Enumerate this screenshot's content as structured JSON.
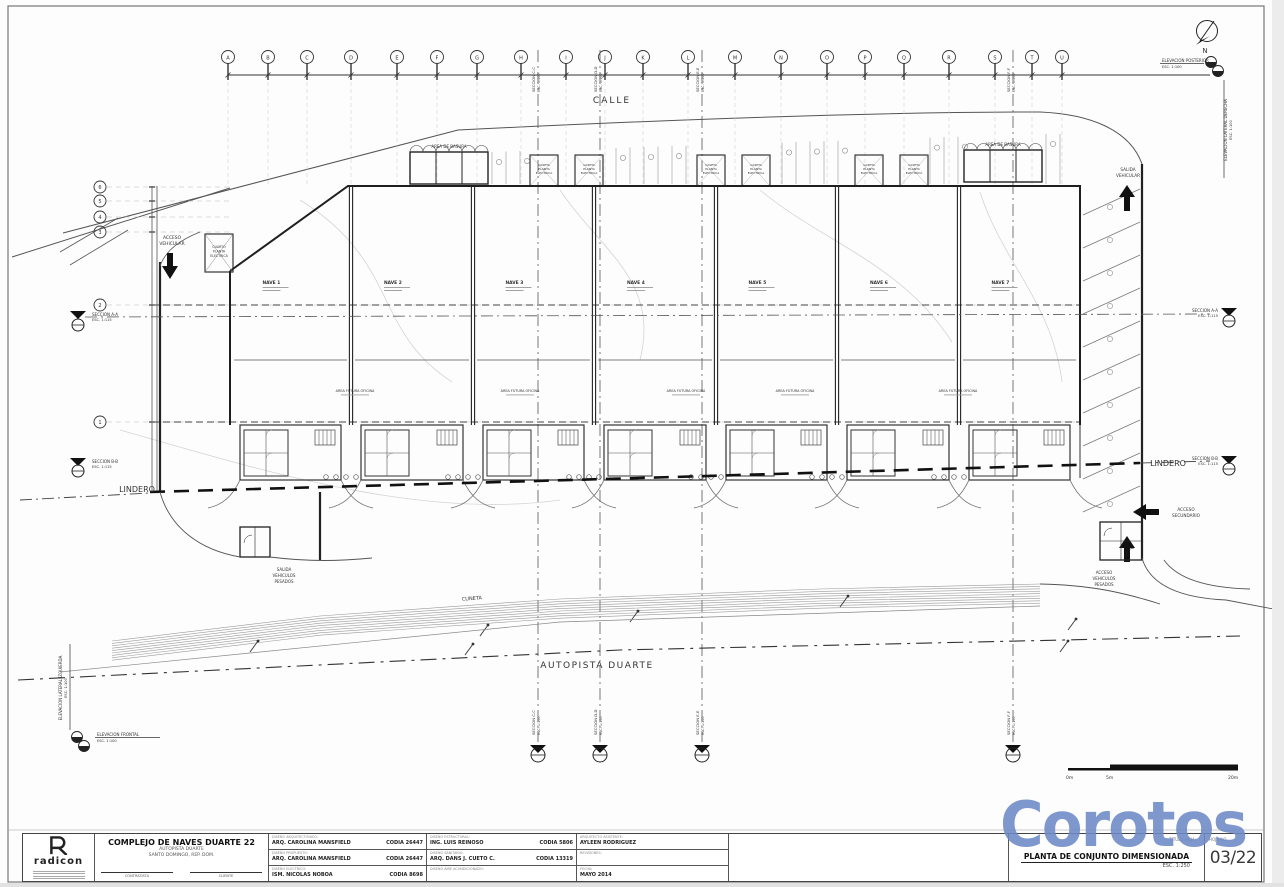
{
  "watermark": "Corotos",
  "labels": {
    "calle": "CALLE",
    "autopista": "AUTOPISTA DUARTE",
    "cuneta": "CUNETA",
    "lindero": "LINDERO",
    "acceso_vehicular": [
      "ACCESO",
      "VEHICULAR"
    ],
    "salida_vehicular": [
      "SALIDA",
      "VEHICULAR"
    ],
    "acceso_secundario": [
      "ACCESO",
      "SECUNDARIO"
    ],
    "salida_pesados": [
      "SALIDA",
      "VEHICULOS",
      "PESADOS"
    ],
    "acceso_pesados": [
      "ACCESO",
      "VEHICULOS",
      "PESADOS"
    ],
    "area_basura": "AREA DE BASURA",
    "caseta": [
      "CASETA",
      "PLANTA",
      "ELECTRICA"
    ],
    "cuarto_planta": [
      "CUARTO",
      "PLANTA",
      "ELECTRICA"
    ],
    "area_futura": "AREA FUTURA OFICINA",
    "north": "N",
    "scale_ticks": [
      "0m",
      "5m",
      "20m"
    ],
    "sections": {
      "aa": [
        "SECCION A-A",
        "ESC. 1:115"
      ],
      "bb": [
        "SECCION B-B",
        "ESC. 1:115"
      ],
      "cc": [
        "SECCION C-C",
        "ESC. 1:100"
      ],
      "dd": [
        "SECCION D-D",
        "ESC. 1:100"
      ],
      "ee": [
        "SECCION E-E",
        "ESC. 1:100"
      ],
      "ff": [
        "SECCION F-F",
        "ESC. 1:100"
      ]
    },
    "elev_posterior": [
      "ELEVACION POSTERIOR",
      "ESC. 1:100"
    ],
    "elev_lat_derecha": [
      "ELEVACION LATERAL DERECHA",
      "ESC. 1:100"
    ],
    "elev_lat_izquierda": [
      "ELEVACION LATERAL IZQUIERDA",
      "ESC. 1:100"
    ],
    "elev_frontal": [
      "ELEVACION FRONTAL",
      "ESC. 1:100"
    ]
  },
  "plan": {
    "grid_letters": [
      "A",
      "B",
      "C",
      "D",
      "E",
      "F",
      "G",
      "H",
      "I",
      "J",
      "K",
      "L",
      "M",
      "N",
      "O",
      "P",
      "Q",
      "R",
      "S",
      "T",
      "U"
    ],
    "grid_xs": [
      228,
      268,
      307,
      351,
      397,
      437,
      477,
      521,
      566,
      605,
      643,
      688,
      735,
      781,
      827,
      865,
      904,
      949,
      995,
      1032,
      1062
    ],
    "row_numbers": [
      "6",
      "5",
      "4",
      "3",
      "2",
      "1"
    ],
    "row_ys": [
      187,
      201,
      217,
      232,
      305,
      422
    ],
    "nave_labels": [
      "NAVE 1",
      "NAVE 2",
      "NAVE 3",
      "NAVE 4",
      "NAVE 5",
      "NAVE 6",
      "NAVE 7"
    ],
    "nave_bounds": [
      230,
      351,
      473,
      594,
      716,
      837,
      959,
      1080
    ],
    "area_futura_xs": [
      355,
      520,
      686,
      795,
      958
    ],
    "caseta_xs": [
      544,
      589,
      711,
      756,
      869,
      914
    ],
    "basura_boxes": [
      {
        "x": 410,
        "y": 152
      },
      {
        "x": 964,
        "y": 150
      }
    ],
    "sections_vertical": [
      {
        "x": 538,
        "key": "cc"
      },
      {
        "x": 600,
        "key": "dd"
      },
      {
        "x": 702,
        "key": "ee"
      },
      {
        "x": 1013,
        "key": "ff"
      }
    ]
  },
  "sheet": {
    "logo_word": "radicon",
    "project": {
      "title": "COMPLEJO DE NAVES DUARTE 22",
      "line2": "AUTOPISTA DUARTE",
      "line3": "SANTO DOMINGO, REP. DOM."
    },
    "signatures": {
      "left": "CONTRATISTA",
      "right": "CLIENTE"
    },
    "credits": [
      {
        "width": 158,
        "rows": [
          {
            "header": "DISEÑO ARQUITECTONICO:",
            "name": "ARQ. CAROLINA MANSFIELD",
            "codia": "CODIA 26447"
          },
          {
            "header": "DISEÑO PROPUESTO:",
            "name": "ARQ. CAROLINA MANSFIELD",
            "codia": "CODIA 26447"
          },
          {
            "header": "DISEÑO ELECTRICO:",
            "name": "ISM. NICOLAS NOBOA",
            "codia": "CODIA 8698"
          }
        ]
      },
      {
        "width": 150,
        "rows": [
          {
            "header": "DISEÑO ESTRUCTURAL:",
            "name": "ING. LUIS REINOSO",
            "codia": "CODIA 5806"
          },
          {
            "header": "DISEÑO SANITARIO:",
            "name": "ARQ. DANS J. CUETO C.",
            "codia": "CODIA 13319"
          },
          {
            "header": "DISEÑO AIRE ACONDICIONADO:",
            "name": "",
            "codia": ""
          }
        ]
      },
      {
        "width": 152,
        "rows": [
          {
            "header": "ARQUITECTO ASISTENTE:",
            "name": "AYLEEN RODRIGUEZ",
            "codia": ""
          },
          {
            "header": "REVISIONES:",
            "name": "",
            "codia": ""
          },
          {
            "header": "FECHA:",
            "name": "MAYO 2014",
            "codia": ""
          }
        ]
      }
    ],
    "sheet_title": {
      "header": "TITULO HOJA:",
      "title": "PLANTA DE CONJUNTO DIMENSIONADA",
      "scale": "ESC.  1:250"
    },
    "page": {
      "header": "HOJA NO.",
      "number": "03/22"
    }
  },
  "colors": {
    "line_dark": "#2e2e2e",
    "line_mid": "#666666",
    "line_light": "#b5b5b5",
    "watermark_blue": "#6c8ac7"
  }
}
